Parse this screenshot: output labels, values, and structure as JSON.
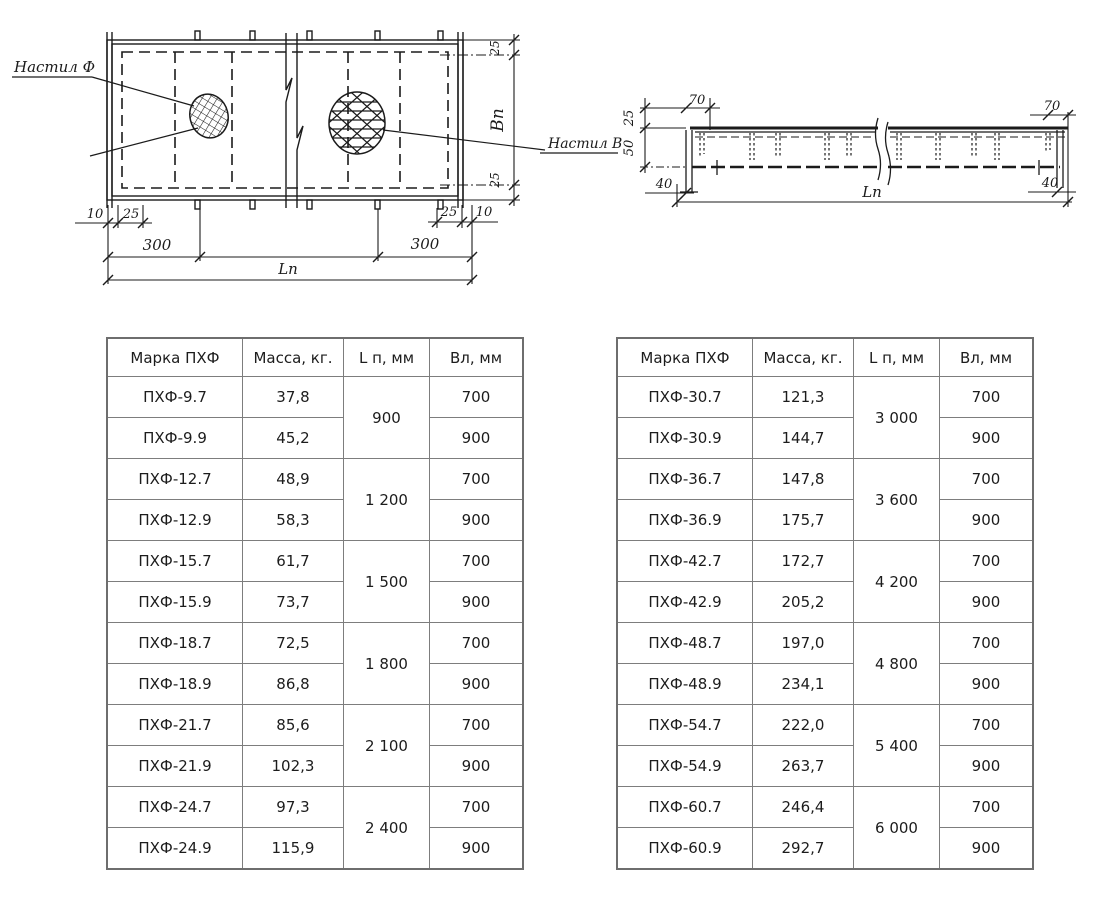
{
  "colors": {
    "ink": "#1b1b1b",
    "table_border": "#7d7d7d",
    "table_text": "#1c1c1c",
    "background": "#ffffff"
  },
  "drawings": {
    "plan": {
      "deck_f_label": "Настил Ф",
      "deck_v_label": "Настил В",
      "dim_left_10": "10",
      "dim_left_25": "25",
      "dim_300_left": "300",
      "dim_300_right": "300",
      "dim_right_25": "25",
      "dim_right_10": "10",
      "dim_length": "Lп",
      "dim_top_25": "25",
      "dim_width_label": "Вп",
      "dim_bottom_25": "25"
    },
    "section": {
      "dim_25": "25",
      "dim_50": "50",
      "dim_70_left": "70",
      "dim_70_right": "70",
      "dim_40_left": "40",
      "dim_40_right": "40",
      "dim_length": "Lп"
    }
  },
  "tables": {
    "headers": [
      "Марка ПХФ",
      "Масса, кг.",
      "L п, мм",
      "Вл, мм"
    ],
    "left": {
      "groups": [
        {
          "length": "900",
          "rows": [
            {
              "mark": "ПХФ-9.7",
              "mass": "37,8",
              "width": "700"
            },
            {
              "mark": "ПХФ-9.9",
              "mass": "45,2",
              "width": "900"
            }
          ]
        },
        {
          "length": "1 200",
          "rows": [
            {
              "mark": "ПХФ-12.7",
              "mass": "48,9",
              "width": "700"
            },
            {
              "mark": "ПХФ-12.9",
              "mass": "58,3",
              "width": "900"
            }
          ]
        },
        {
          "length": "1 500",
          "rows": [
            {
              "mark": "ПХФ-15.7",
              "mass": "61,7",
              "width": "700"
            },
            {
              "mark": "ПХФ-15.9",
              "mass": "73,7",
              "width": "900"
            }
          ]
        },
        {
          "length": "1 800",
          "rows": [
            {
              "mark": "ПХФ-18.7",
              "mass": "72,5",
              "width": "700"
            },
            {
              "mark": "ПХФ-18.9",
              "mass": "86,8",
              "width": "900"
            }
          ]
        },
        {
          "length": "2 100",
          "rows": [
            {
              "mark": "ПХФ-21.7",
              "mass": "85,6",
              "width": "700"
            },
            {
              "mark": "ПХФ-21.9",
              "mass": "102,3",
              "width": "900"
            }
          ]
        },
        {
          "length": "2 400",
          "rows": [
            {
              "mark": "ПХФ-24.7",
              "mass": "97,3",
              "width": "700"
            },
            {
              "mark": "ПХФ-24.9",
              "mass": "115,9",
              "width": "900"
            }
          ]
        }
      ]
    },
    "right": {
      "groups": [
        {
          "length": "3 000",
          "rows": [
            {
              "mark": "ПХФ-30.7",
              "mass": "121,3",
              "width": "700"
            },
            {
              "mark": "ПХФ-30.9",
              "mass": "144,7",
              "width": "900"
            }
          ]
        },
        {
          "length": "3 600",
          "rows": [
            {
              "mark": "ПХФ-36.7",
              "mass": "147,8",
              "width": "700"
            },
            {
              "mark": "ПХФ-36.9",
              "mass": "175,7",
              "width": "900"
            }
          ]
        },
        {
          "length": "4 200",
          "rows": [
            {
              "mark": "ПХФ-42.7",
              "mass": "172,7",
              "width": "700"
            },
            {
              "mark": "ПХФ-42.9",
              "mass": "205,2",
              "width": "900"
            }
          ]
        },
        {
          "length": "4 800",
          "rows": [
            {
              "mark": "ПХФ-48.7",
              "mass": "197,0",
              "width": "700"
            },
            {
              "mark": "ПХФ-48.9",
              "mass": "234,1",
              "width": "900"
            }
          ]
        },
        {
          "length": "5 400",
          "rows": [
            {
              "mark": "ПХФ-54.7",
              "mass": "222,0",
              "width": "700"
            },
            {
              "mark": "ПХФ-54.9",
              "mass": "263,7",
              "width": "900"
            }
          ]
        },
        {
          "length": "6 000",
          "rows": [
            {
              "mark": "ПХФ-60.7",
              "mass": "246,4",
              "width": "700"
            },
            {
              "mark": "ПХФ-60.9",
              "mass": "292,7",
              "width": "900"
            }
          ]
        }
      ]
    }
  }
}
